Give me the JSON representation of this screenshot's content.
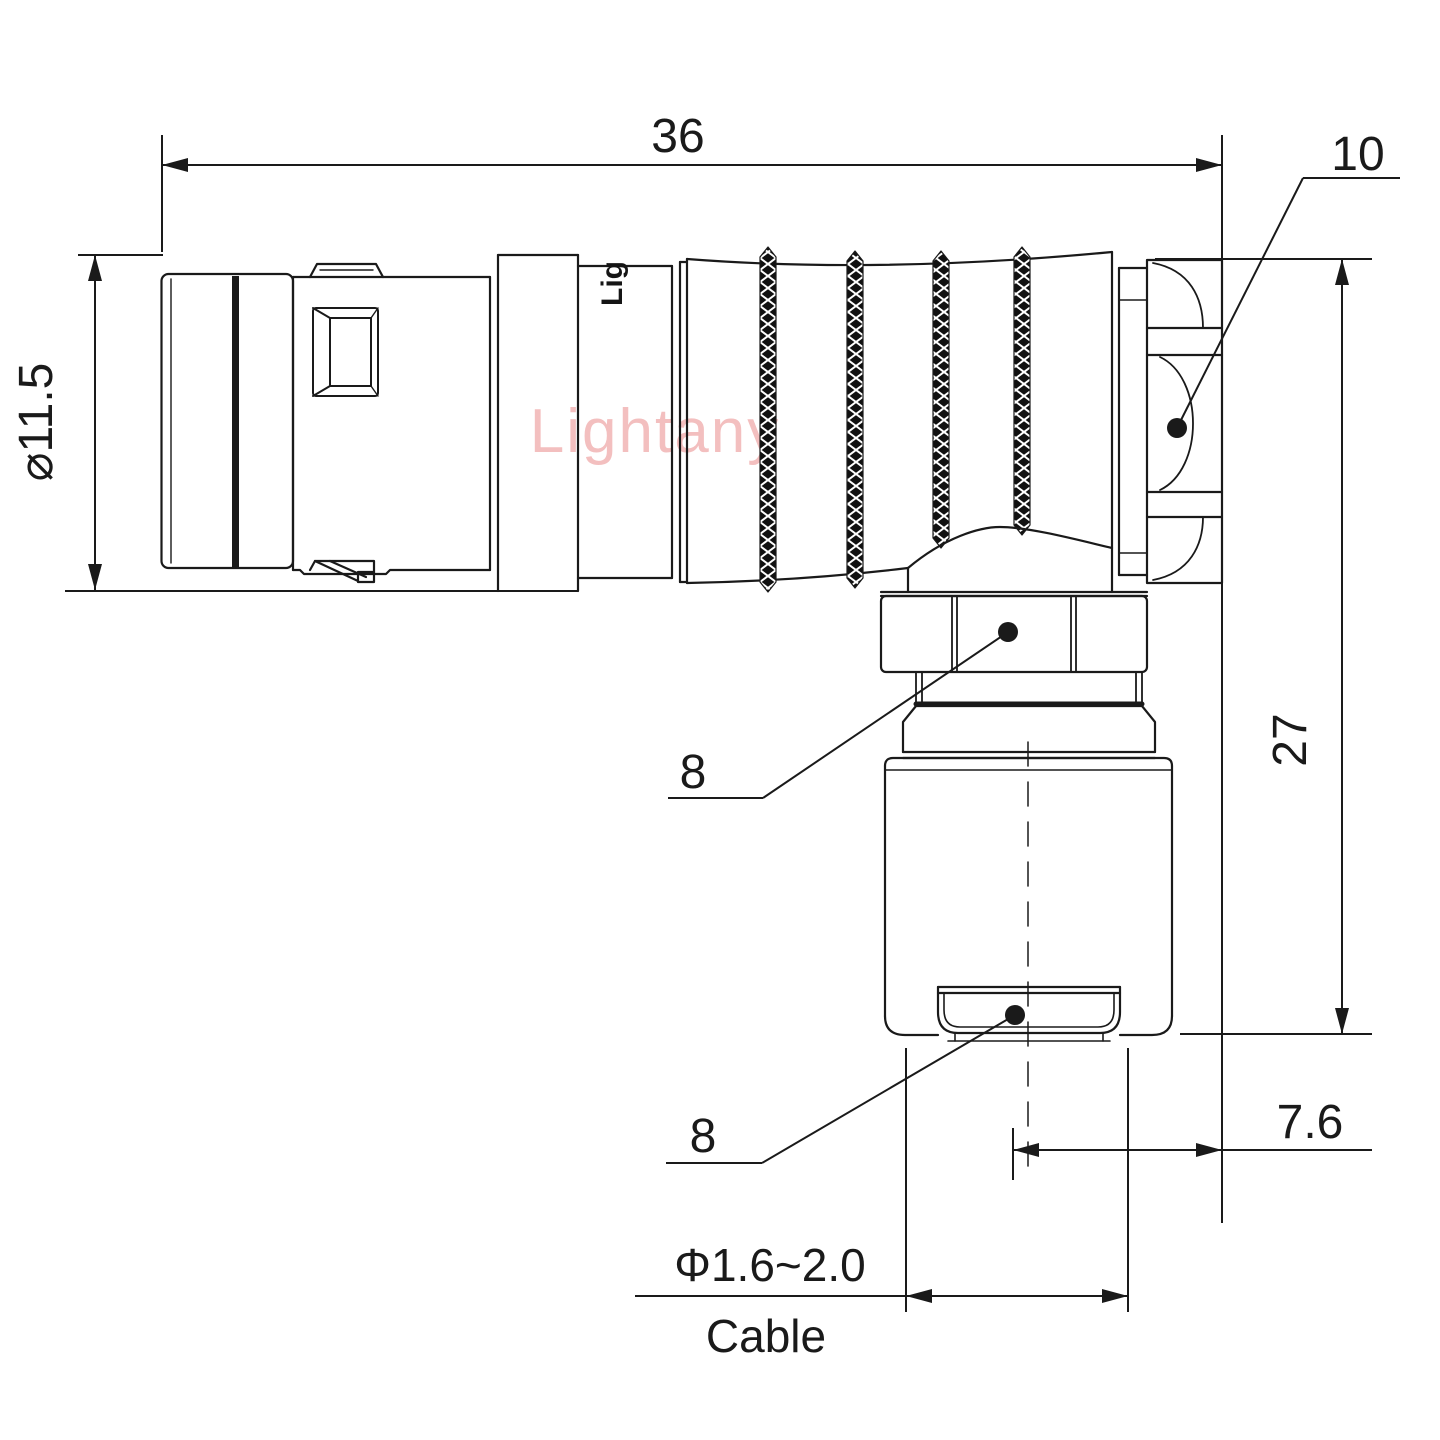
{
  "drawing": {
    "type": "technical-connector-drawing",
    "watermark": "Lightany",
    "engraving": "Lig",
    "colors": {
      "line": "#1a1a1a",
      "watermark": "#f3bfbf",
      "background": "#ffffff"
    },
    "dimensions": {
      "overall_length": {
        "label": "36"
      },
      "cap_size": {
        "label": "10"
      },
      "shell_diameter": {
        "label": "⌀11.5"
      },
      "height": {
        "label": "27"
      },
      "gland_nut": {
        "label": "8"
      },
      "clamp_nut": {
        "label": "8"
      },
      "axis_offset": {
        "label": "7.6"
      },
      "cable_range": {
        "label": "Φ1.6~2.0"
      },
      "cable_word": {
        "label": "Cable"
      }
    }
  }
}
